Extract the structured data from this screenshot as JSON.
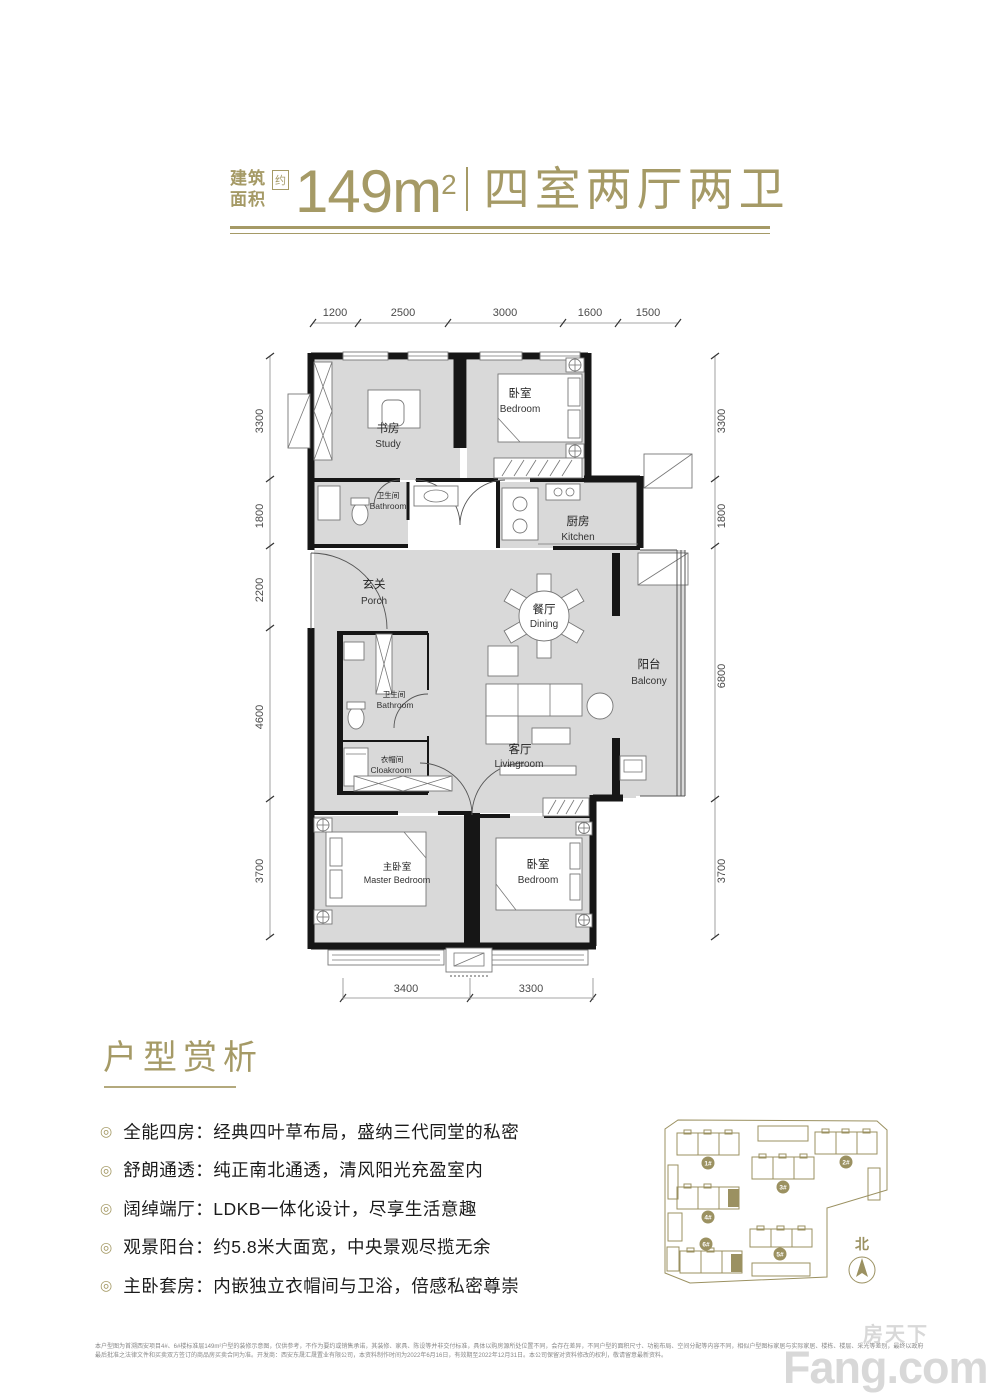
{
  "header": {
    "area_label_1": "建筑",
    "area_label_2": "面积",
    "approx": "约",
    "area": "149m",
    "area_sup": "2",
    "title": "四室两厅两卫"
  },
  "floorplan": {
    "dims": {
      "top": [
        "1200",
        "2500",
        "3000",
        "1600",
        "1500"
      ],
      "left": [
        "3300",
        "1800",
        "2200",
        "4600",
        "3700"
      ],
      "right": [
        "3300",
        "1800",
        "6800",
        "3700"
      ],
      "bottom": [
        "3400",
        "3300"
      ]
    },
    "rooms": {
      "study": {
        "zh": "书房",
        "en": "Study"
      },
      "bedroom_top": {
        "zh": "卧室",
        "en": "Bedroom"
      },
      "bathroom_top": {
        "zh": "卫生间",
        "en": "Bathroom"
      },
      "kitchen": {
        "zh": "厨房",
        "en": "Kitchen"
      },
      "porch": {
        "zh": "玄关",
        "en": "Porch"
      },
      "dining": {
        "zh": "餐厅",
        "en": "Dining"
      },
      "balcony": {
        "zh": "阳台",
        "en": "Balcony"
      },
      "bathroom_mid": {
        "zh": "卫生间",
        "en": "Bathroom"
      },
      "cloakroom": {
        "zh": "衣帽间",
        "en": "Cloakroom"
      },
      "living": {
        "zh": "客厅",
        "en": "Livingroom"
      },
      "master": {
        "zh": "主卧室",
        "en": "Master Bedroom"
      },
      "bedroom_bottom": {
        "zh": "卧室",
        "en": "Bedroom"
      }
    }
  },
  "analysis": {
    "title": "户型赏析",
    "bullets": [
      "全能四房：经典四叶草布局，盛纳三代同堂的私密",
      "舒朗通透：纯正南北通透，清风阳光充盈室内",
      "阔绰端厅：LDKB一体化设计，尽享生活意趣",
      "观景阳台：约5.8米大面宽，中央景观尽揽无余",
      "主卧套房：内嵌独立衣帽间与卫浴，倍感私密尊崇"
    ],
    "bullet_icon": "◎"
  },
  "siteplan": {
    "north": "北",
    "buildings": [
      "1#",
      "2#",
      "3#",
      "4#",
      "5#",
      "6#"
    ]
  },
  "footer": {
    "disclaimer_1": "本户型图为首溯西安项目4#、6#楼标准层149m²户型的装修示意图，仅供参考，不作为要约或销售承诺，其装修、家具、陈设等并非交付标准，具体以购房源所处位置不同，会存在差异，不同户型的面积尺寸、功能布局、空间分配等内容不同，相似户型图标家居与实际家居、楼栋、楼层、采光等差别，最终以政府",
    "disclaimer_2": "最后批准之法律文件和买卖双方签订的商品房买卖合同为准。开发商：西安东晟汇晟置业有限公司，本资料制作时间为2022年6月16日，有效期至2022年12月31日。本公司保留对资料修改的权利，敬请留意最新资料。",
    "watermark_zh": "房天下",
    "watermark_en": "Fang.com"
  },
  "colors": {
    "gold": "#a59a66",
    "siteplan_gold": "#9b9161",
    "floor_gray": "#d9d9d9",
    "wall_black": "#161616"
  }
}
